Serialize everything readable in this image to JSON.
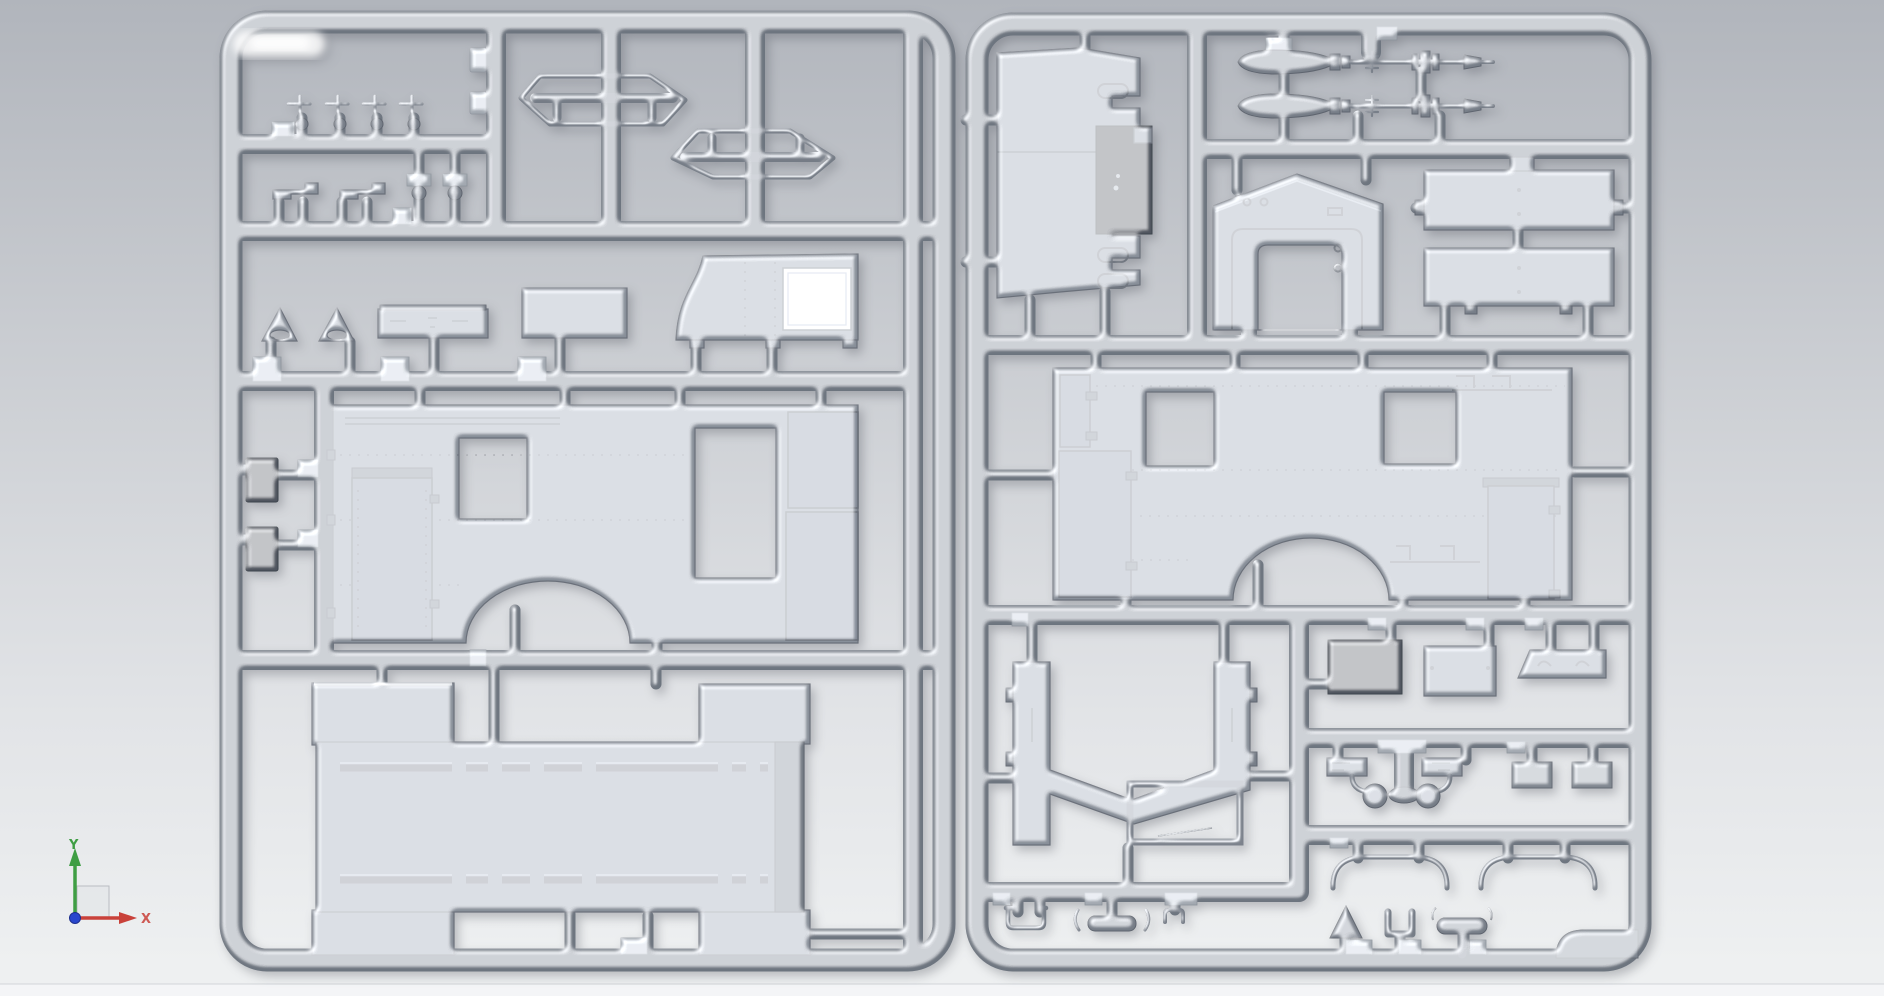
{
  "scene": {
    "title": "3D CAD viewport - injection mold sprue preview",
    "view": "front orthographic"
  },
  "viewport": {
    "background_top": "#b1b5bc",
    "background_mid": "#c8cbd0",
    "background_low": "#e2e4e7",
    "background_bottom": "#eef0f1",
    "footer_strip": "#f4f5f7",
    "footer_line": "#d2d5d9"
  },
  "axis_triad": {
    "x_label": "X",
    "y_label": "Y",
    "x_color": "#c9413a",
    "y_color": "#3f9e44",
    "origin_color": "#2846cd",
    "plane_fill": "#e4e6e9",
    "plane_border": "#b9bcc2"
  },
  "sprue_material": {
    "tube": "#6d747f",
    "tube_dark": "#4c525c",
    "tube_light": "#a6adb6",
    "part": "#878e98",
    "part_dark": "#4f555f",
    "part_light": "#a8aeb6",
    "opening": "#c9ccd1"
  },
  "sprues": {
    "left": {
      "name": "sprue-left",
      "parts": [
        "screw-pins x4",
        "hinge-clips x2",
        "latch-brackets x2",
        "grab-handle-loops x2",
        "warning-triangles x2",
        "slotted-strip",
        "blank-panel",
        "cab-side-panel",
        "storage-boxes x2",
        "body-side-panel",
        "roof-panel"
      ]
    },
    "right": {
      "name": "sprue-right",
      "parts": [
        "rear-door-panel",
        "missiles x2",
        "door-bulkhead-arch",
        "bed-panels x2",
        "body-side-panel",
        "wheel-well-tub",
        "equipment-boxes x3",
        "side-mirrors x2",
        "plates x2",
        "roof-bows x2",
        "reflector-triangle",
        "u-bracket",
        "tow-handle",
        "wire-clips x3"
      ]
    }
  }
}
